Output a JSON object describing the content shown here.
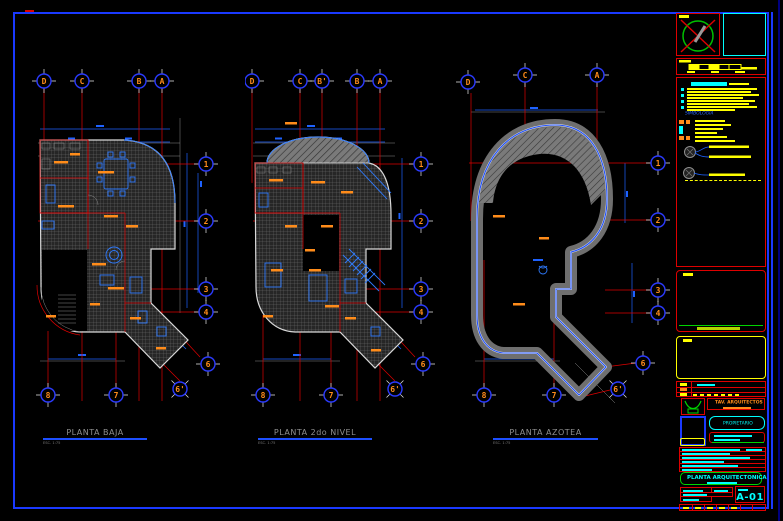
{
  "colors": {
    "paper": "#000000",
    "border_blue": "#1a39ff",
    "grid_red": "#de0000",
    "dim_blue": "#1e62ff",
    "bubble_ring_blue": "#2b3bff",
    "label_orange": "#ff8c1a",
    "wall_white": "#d9d9d9",
    "roof_gray": "#6f6f6f",
    "note_yellow": "#ffff00",
    "accent_cyan": "#00ffff",
    "accent_green": "#00d400",
    "title_gray": "#8f8f8f"
  },
  "plans": [
    {
      "title": "PLANTA BAJA",
      "scale_note": "ESC. 1:75",
      "grid_top": [
        "D",
        "C",
        "B",
        "A"
      ],
      "grid_right": [
        "1",
        "2",
        "3",
        "4"
      ],
      "grid_diagonal": [
        "6",
        "6'"
      ],
      "grid_bottom": [
        "8",
        "7"
      ]
    },
    {
      "title": "PLANTA 2do NIVEL",
      "scale_note": "ESC. 1:75",
      "grid_top": [
        "D",
        "C",
        "B'",
        "B",
        "A"
      ],
      "grid_right": [
        "1",
        "2",
        "3",
        "4"
      ],
      "grid_diagonal": [
        "6",
        "6'"
      ],
      "grid_bottom": [
        "8",
        "7"
      ]
    },
    {
      "title": "PLANTA AZOTEA",
      "scale_note": "ESC. 1:75",
      "grid_top": [
        "D",
        "C",
        "A"
      ],
      "grid_right": [
        "1",
        "2",
        "3",
        "4"
      ],
      "grid_diagonal": [
        "6",
        "6'"
      ],
      "grid_bottom": [
        "8",
        "7"
      ]
    }
  ],
  "titleblock": {
    "firm": "TAV. ARQUITECTOS",
    "owner_label": "PROPIETARIO",
    "legend_title": "SIMBOLOGIA",
    "project_title": "PLANTA ARQUITECTONICA",
    "sheet_code": "A-01"
  }
}
